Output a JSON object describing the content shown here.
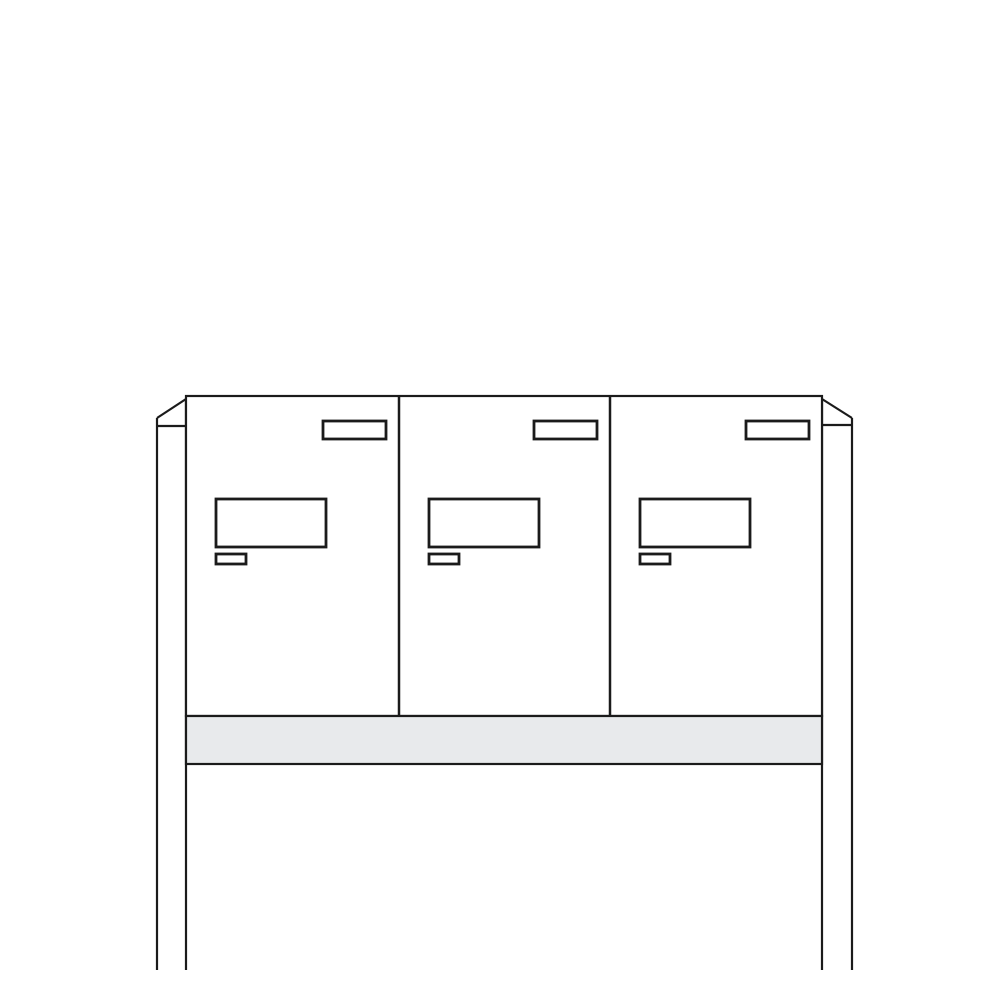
{
  "illustration": {
    "title": "free-standing-letterbox-unit-3-compartments",
    "background": "#ffffff",
    "stroke_color": "#1b1b1b",
    "structure_stroke_width": 2.2,
    "feature_stroke_width": 2.8,
    "body_fill": "#ffffff",
    "shelf_fill": "#e8eaec",
    "canvas": {
      "width": 1000,
      "height": 1000
    },
    "posts": {
      "left": {
        "outer_x": 157,
        "inner_x": 186,
        "shoulder_y": 418,
        "peak_y": 399,
        "cap_y": 426,
        "bottom_y": 970
      },
      "right": {
        "outer_x": 852,
        "inner_x": 822,
        "shoulder_y": 418,
        "peak_y": 399,
        "cap_y": 425,
        "bottom_y": 970
      }
    },
    "cabinet": {
      "x": 186,
      "y": 396,
      "width": 636,
      "height": 320
    },
    "dividers_x": [
      399,
      610
    ],
    "shelf": {
      "x": 186,
      "y": 716,
      "width": 636,
      "height": 48
    },
    "compartments": [
      {
        "id": 1,
        "x": 186,
        "width": 213
      },
      {
        "id": 2,
        "x": 399,
        "width": 211
      },
      {
        "id": 3,
        "x": 610,
        "width": 212
      }
    ],
    "features": {
      "name_plate": {
        "right_offset": 13,
        "width": 63,
        "y": 421,
        "height": 18
      },
      "letter_flap": {
        "left_offset": 30,
        "width": 110,
        "y": 499,
        "height": 48
      },
      "lock": {
        "left_offset": 30,
        "width": 30,
        "y": 554,
        "height": 10
      }
    }
  }
}
